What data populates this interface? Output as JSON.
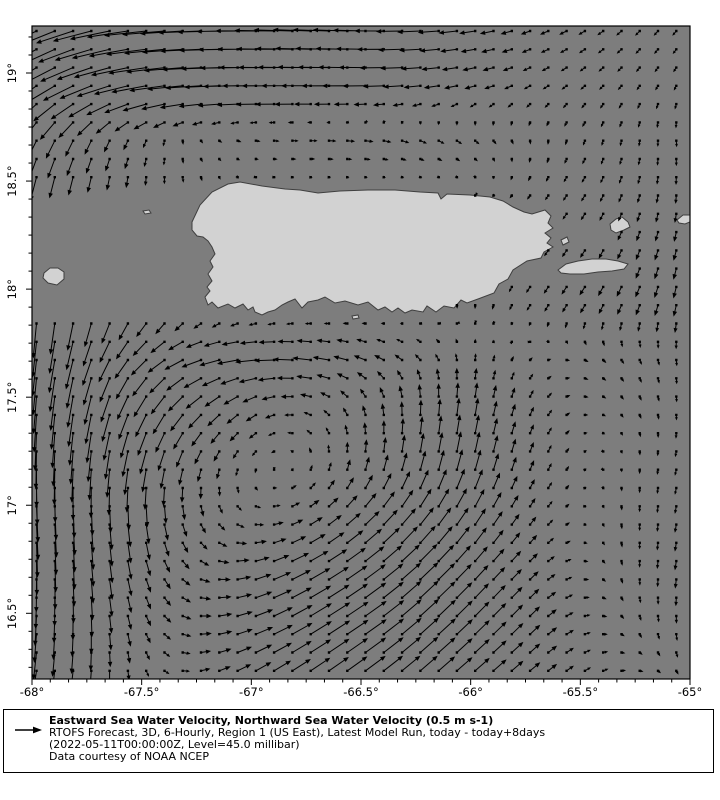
{
  "page": {
    "background": "#ffffff"
  },
  "map": {
    "frame": {
      "left": 32,
      "top": 26,
      "right": 690,
      "bottom": 679
    },
    "colors": {
      "ocean": "#7d7d7d",
      "land": "#d2d2d2",
      "coastline": "#3f3f3f",
      "arrow": "#000000",
      "frame": "#000000",
      "legend_bg": "#ffffcc"
    }
  },
  "axes": {
    "x_ticks": [
      {
        "label": "-68°",
        "lon": -68.0
      },
      {
        "label": "-67.5°",
        "lon": -67.5
      },
      {
        "label": "-67°",
        "lon": -67.0
      },
      {
        "label": "-66.5°",
        "lon": -66.5
      },
      {
        "label": "-66°",
        "lon": -66.0
      },
      {
        "label": "-65.5°",
        "lon": -65.5
      },
      {
        "label": "-65°",
        "lon": -65.0
      }
    ],
    "y_ticks": [
      {
        "label": "19°",
        "lat": 19.0
      },
      {
        "label": "18.5°",
        "lat": 18.5
      },
      {
        "label": "18°",
        "lat": 18.0
      },
      {
        "label": "17.5°",
        "lat": 17.5
      },
      {
        "label": "17°",
        "lat": 17.0
      },
      {
        "label": "16.5°",
        "lat": 16.5
      }
    ]
  },
  "legend": {
    "title": "Eastward Sea Water Velocity, Northward Sea Water Velocity (0.5 m s-1)",
    "line2": "RTOFS Forecast, 3D, 6-Hourly, Region 1 (US East), Latest Model Run, today - today+8days",
    "line3": "(2022-05-11T00:00:00Z, Level=45.0 millibar)",
    "line4": "Data courtesy of NOAA NCEP",
    "reference_value": "0.5 m s-1"
  },
  "chart_data": {
    "type": "quiver",
    "title": "Eastward Sea Water Velocity, Northward Sea Water Velocity (0.5 m s-1)",
    "subtitle": "RTOFS Forecast, 3D, 6-Hourly, Region 1 (US East), Latest Model Run, today - today+8days",
    "timestamp": "2022-05-11T00:00:00Z",
    "level": "45.0 millibar",
    "credit": "Data courtesy of NOAA NCEP",
    "xlabel": "longitude (deg east)",
    "ylabel": "latitude (deg north)",
    "lon_range": [
      -68.0,
      -65.0
    ],
    "lat_range": [
      16.18,
      19.22
    ],
    "reference_arrow": {
      "value_ms": 0.5,
      "px": 23
    },
    "scale_px_per_ms": 48,
    "arrow_grid_step_px": 18.28,
    "flow_features": [
      "strong westward jet along northern edge near 19N, curving southwest at the western boundary",
      "strong southward boundary current along 68W from 18.6N to the southern edge",
      "cyclonic (counterclockwise) eddy centered near 67.0W 17.1N south of Puerto Rico",
      "northeastward return flow across the southeastern quadrant",
      "weak eastward counterflow just north of Puerto Rico near 18.6N",
      "weak southward drift in the northeast corner and along the eastern edge"
    ],
    "grid": {
      "units": "m s-1",
      "lons": [
        -68.0,
        -67.75,
        -67.5,
        -67.25,
        -67.0,
        -66.75,
        -66.5,
        -66.25,
        -66.0,
        -65.75,
        -65.5,
        -65.25,
        -65.0
      ],
      "lats": [
        19.2,
        18.95,
        18.7,
        18.45,
        18.2,
        17.95,
        17.7,
        17.45,
        17.2,
        16.95,
        16.7,
        16.45,
        16.2
      ],
      "u": [
        [
          -0.7,
          -0.8,
          -0.88,
          -0.9,
          -0.85,
          -0.8,
          -0.7,
          -0.5,
          -0.35,
          -0.2,
          -0.14,
          -0.1,
          -0.08
        ],
        [
          -0.55,
          -0.68,
          -0.75,
          -0.78,
          -0.74,
          -0.66,
          -0.52,
          -0.38,
          -0.25,
          -0.14,
          -0.1,
          -0.07,
          -0.05
        ],
        [
          -0.22,
          -0.15,
          -0.08,
          0.04,
          0.1,
          0.15,
          0.18,
          0.15,
          0.1,
          0.02,
          -0.04,
          -0.02,
          0.02
        ],
        [
          -0.1,
          -0.06,
          0.0,
          0.02,
          0.0,
          0.0,
          0.0,
          0.0,
          0.0,
          -0.06,
          -0.08,
          -0.05,
          0.0
        ],
        [
          -0.05,
          -0.08,
          -0.1,
          -0.02,
          0.0,
          0.0,
          0.0,
          0.0,
          0.0,
          -0.08,
          -0.1,
          -0.08,
          -0.05
        ],
        [
          -0.05,
          -0.1,
          -0.13,
          0.04,
          0.08,
          0.1,
          0.06,
          0.04,
          0.0,
          -0.08,
          -0.12,
          -0.1,
          -0.05
        ],
        [
          -0.08,
          -0.18,
          -0.32,
          -0.42,
          -0.46,
          -0.42,
          -0.28,
          -0.14,
          0.0,
          0.05,
          0.08,
          0.05,
          0.0
        ],
        [
          -0.05,
          -0.12,
          -0.24,
          -0.3,
          -0.24,
          -0.18,
          -0.08,
          0.0,
          0.05,
          0.08,
          0.08,
          0.04,
          0.0
        ],
        [
          0.0,
          -0.05,
          -0.1,
          -0.1,
          -0.05,
          0.0,
          0.04,
          0.08,
          0.1,
          0.08,
          0.04,
          0.0,
          -0.04
        ],
        [
          0.04,
          0.04,
          0.05,
          0.08,
          0.14,
          0.22,
          0.27,
          0.27,
          0.22,
          0.13,
          0.04,
          0.0,
          -0.04
        ],
        [
          0.0,
          0.04,
          0.09,
          0.18,
          0.31,
          0.4,
          0.42,
          0.38,
          0.28,
          0.18,
          0.09,
          0.0,
          -0.04
        ],
        [
          -0.04,
          0.0,
          0.09,
          0.22,
          0.36,
          0.45,
          0.45,
          0.4,
          0.31,
          0.22,
          0.13,
          0.04,
          0.0
        ],
        [
          -0.09,
          -0.04,
          0.04,
          0.18,
          0.31,
          0.4,
          0.42,
          0.36,
          0.31,
          0.22,
          0.13,
          0.09,
          0.04
        ]
      ],
      "v": [
        [
          -0.35,
          -0.22,
          -0.1,
          -0.04,
          0.0,
          0.03,
          0.02,
          -0.02,
          -0.05,
          -0.07,
          -0.08,
          -0.1,
          -0.1
        ],
        [
          -0.4,
          -0.28,
          -0.14,
          -0.05,
          0.0,
          0.0,
          0.0,
          -0.03,
          -0.06,
          -0.07,
          -0.08,
          -0.09,
          -0.1
        ],
        [
          -0.42,
          -0.3,
          -0.16,
          -0.06,
          -0.02,
          0.0,
          -0.02,
          -0.06,
          -0.08,
          -0.08,
          -0.1,
          -0.12,
          -0.14
        ],
        [
          -0.55,
          -0.35,
          -0.2,
          -0.1,
          0.0,
          0.0,
          0.0,
          0.0,
          0.0,
          -0.08,
          -0.12,
          -0.15,
          -0.18
        ],
        [
          -0.68,
          -0.42,
          -0.24,
          -0.12,
          0.0,
          0.0,
          0.0,
          0.0,
          0.0,
          -0.1,
          -0.15,
          -0.2,
          -0.22
        ],
        [
          -0.72,
          -0.48,
          -0.28,
          -0.1,
          -0.04,
          -0.04,
          -0.05,
          -0.08,
          -0.1,
          -0.13,
          -0.18,
          -0.22,
          -0.26
        ],
        [
          -0.78,
          -0.55,
          -0.32,
          -0.14,
          -0.04,
          0.04,
          0.08,
          0.1,
          0.12,
          0.05,
          -0.04,
          -0.1,
          -0.14
        ],
        [
          -0.8,
          -0.62,
          -0.48,
          -0.3,
          -0.16,
          0.04,
          0.18,
          0.3,
          0.36,
          0.18,
          0.0,
          -0.08,
          -0.13
        ],
        [
          -0.8,
          -0.66,
          -0.5,
          -0.28,
          -0.1,
          0.08,
          0.26,
          0.4,
          0.45,
          0.22,
          0.04,
          -0.08,
          -0.13
        ],
        [
          -0.76,
          -0.62,
          -0.45,
          -0.22,
          -0.04,
          0.13,
          0.27,
          0.36,
          0.36,
          0.18,
          0.0,
          -0.13,
          -0.18
        ],
        [
          -0.72,
          -0.54,
          -0.31,
          -0.09,
          0.09,
          0.22,
          0.31,
          0.36,
          0.31,
          0.18,
          0.0,
          -0.13,
          -0.22
        ],
        [
          -0.63,
          -0.45,
          -0.22,
          0.0,
          0.13,
          0.27,
          0.31,
          0.36,
          0.31,
          0.22,
          0.04,
          -0.09,
          -0.18
        ],
        [
          -0.54,
          -0.36,
          -0.13,
          0.04,
          0.18,
          0.27,
          0.31,
          0.31,
          0.27,
          0.18,
          0.09,
          0.0,
          -0.09
        ]
      ]
    },
    "islands": [
      {
        "name": "puerto-rico",
        "points": [
          [
            192,
            222
          ],
          [
            200,
            205
          ],
          [
            212,
            192
          ],
          [
            228,
            184
          ],
          [
            240,
            182
          ],
          [
            262,
            186
          ],
          [
            285,
            189
          ],
          [
            300,
            190
          ],
          [
            318,
            193
          ],
          [
            340,
            191
          ],
          [
            368,
            190
          ],
          [
            395,
            190
          ],
          [
            420,
            192
          ],
          [
            438,
            193
          ],
          [
            441,
            199
          ],
          [
            447,
            194
          ],
          [
            470,
            195
          ],
          [
            490,
            197
          ],
          [
            503,
            201
          ],
          [
            513,
            207
          ],
          [
            524,
            212
          ],
          [
            532,
            214
          ],
          [
            545,
            210
          ],
          [
            551,
            216
          ],
          [
            548,
            223
          ],
          [
            553,
            228
          ],
          [
            545,
            233
          ],
          [
            551,
            238
          ],
          [
            547,
            243
          ],
          [
            553,
            247
          ],
          [
            544,
            252
          ],
          [
            541,
            258
          ],
          [
            527,
            261
          ],
          [
            513,
            270
          ],
          [
            508,
            279
          ],
          [
            499,
            284
          ],
          [
            494,
            293
          ],
          [
            478,
            299
          ],
          [
            467,
            303
          ],
          [
            461,
            300
          ],
          [
            454,
            308
          ],
          [
            444,
            306
          ],
          [
            436,
            312
          ],
          [
            427,
            306
          ],
          [
            423,
            312
          ],
          [
            412,
            310
          ],
          [
            405,
            313
          ],
          [
            398,
            308
          ],
          [
            392,
            312
          ],
          [
            385,
            307
          ],
          [
            378,
            310
          ],
          [
            368,
            302
          ],
          [
            358,
            305
          ],
          [
            345,
            301
          ],
          [
            335,
            303
          ],
          [
            325,
            297
          ],
          [
            318,
            300
          ],
          [
            308,
            302
          ],
          [
            302,
            308
          ],
          [
            295,
            299
          ],
          [
            288,
            302
          ],
          [
            282,
            305
          ],
          [
            275,
            310
          ],
          [
            268,
            312
          ],
          [
            262,
            315
          ],
          [
            255,
            312
          ],
          [
            253,
            307
          ],
          [
            248,
            310
          ],
          [
            243,
            304
          ],
          [
            235,
            308
          ],
          [
            228,
            304
          ],
          [
            218,
            308
          ],
          [
            212,
            302
          ],
          [
            208,
            305
          ],
          [
            205,
            297
          ],
          [
            210,
            291
          ],
          [
            207,
            287
          ],
          [
            212,
            281
          ],
          [
            208,
            274
          ],
          [
            213,
            267
          ],
          [
            210,
            261
          ],
          [
            215,
            254
          ],
          [
            212,
            247
          ],
          [
            208,
            241
          ],
          [
            203,
            237
          ],
          [
            197,
            236
          ],
          [
            192,
            230
          ]
        ]
      },
      {
        "name": "vieques",
        "points": [
          [
            558,
            270
          ],
          [
            566,
            264
          ],
          [
            578,
            261
          ],
          [
            592,
            259
          ],
          [
            606,
            259
          ],
          [
            618,
            261
          ],
          [
            628,
            264
          ],
          [
            624,
            269
          ],
          [
            612,
            271
          ],
          [
            598,
            272
          ],
          [
            584,
            274
          ],
          [
            570,
            274
          ],
          [
            561,
            273
          ]
        ]
      },
      {
        "name": "culebra",
        "points": [
          [
            610,
            224
          ],
          [
            616,
            219
          ],
          [
            622,
            217
          ],
          [
            628,
            222
          ],
          [
            630,
            227
          ],
          [
            624,
            230
          ],
          [
            616,
            233
          ],
          [
            611,
            230
          ]
        ]
      },
      {
        "name": "mona",
        "points": [
          [
            44,
            273
          ],
          [
            50,
            268
          ],
          [
            58,
            268
          ],
          [
            64,
            272
          ],
          [
            64,
            279
          ],
          [
            57,
            285
          ],
          [
            48,
            283
          ],
          [
            43,
            278
          ]
        ]
      },
      {
        "name": "desecheo",
        "points": [
          [
            143,
            211
          ],
          [
            149,
            210
          ],
          [
            151,
            213
          ],
          [
            145,
            214
          ]
        ]
      },
      {
        "name": "st-thomas-edge",
        "points": [
          [
            677,
            220
          ],
          [
            683,
            215
          ],
          [
            690,
            215
          ],
          [
            692,
            221
          ],
          [
            685,
            224
          ],
          [
            679,
            223
          ]
        ]
      },
      {
        "name": "islet-east",
        "points": [
          [
            561,
            240
          ],
          [
            567,
            237
          ],
          [
            569,
            242
          ],
          [
            563,
            245
          ]
        ]
      },
      {
        "name": "cay-south",
        "points": [
          [
            352,
            316
          ],
          [
            358,
            315
          ],
          [
            359,
            318
          ],
          [
            353,
            319
          ]
        ]
      }
    ]
  }
}
